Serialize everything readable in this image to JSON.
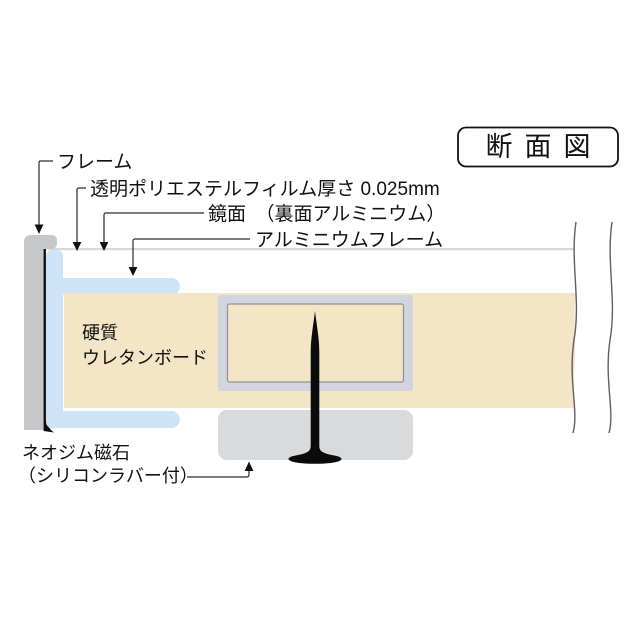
{
  "title_box": {
    "label": "断面図"
  },
  "callouts": {
    "frame": "フレーム",
    "film": "透明ポリエステルフィルム厚さ 0.025mm",
    "mirror": "鏡面　（裏面アルミニウム）",
    "aluminum_frame": "アルミニウムフレーム",
    "board_line1": "硬質",
    "board_line2": "ウレタンボード",
    "magnet_line1": "ネオジム磁石",
    "magnet_line2": "（シリコンラバー付）"
  },
  "colors": {
    "outer_frame": "#c6c7c9",
    "aluminum_frame": "#cde4f7",
    "board": "#f3e5c5",
    "inner_band": "#d2d5dd",
    "inner_stroke": "#8f9099",
    "magnet": "#d9dadc",
    "mirror_line": "#d8d8d8",
    "pin": "#0b0b0b",
    "wave": "#5f5f5f",
    "leader": "#2a2a2a",
    "arrow": "#111111",
    "title_border": "#111111",
    "text": "#111111"
  }
}
